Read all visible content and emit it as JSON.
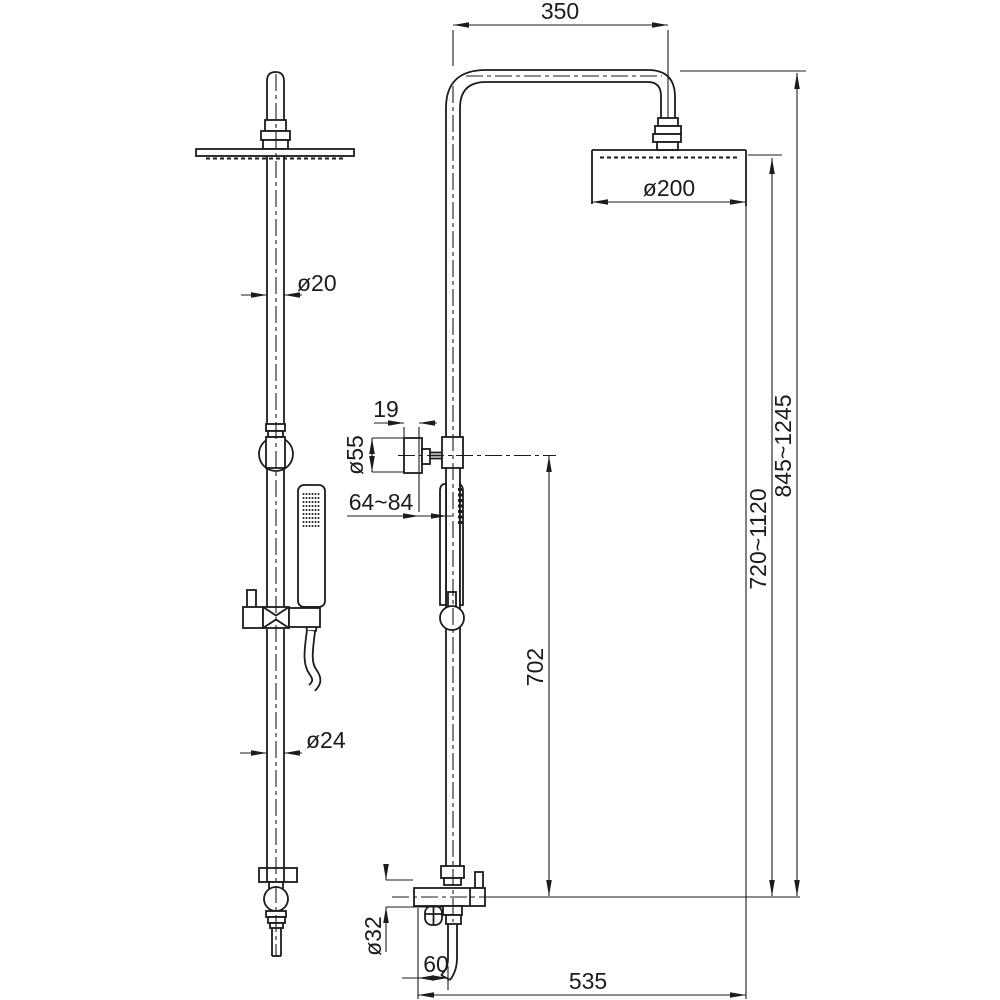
{
  "drawing": {
    "type": "technical-dimension-drawing",
    "subject": "shower column with rain head, hand shower and mixer valve (side view and front view)",
    "colors": {
      "line": "#1c1c1c",
      "background": "#ffffff"
    },
    "dimensions": {
      "arm_offset": "350",
      "head_diameter": "ø200",
      "upper_pipe_diameter": "ø20",
      "bracket_depth": "19",
      "bracket_face_diameter": "ø55",
      "wall_clearance": "64~84",
      "bracket_to_valve": "702",
      "head_to_valve": "720~1120",
      "overall_height": "845~1245",
      "lower_pipe_diameter": "ø24",
      "valve_diameter": "ø32",
      "outlet_offset": "60",
      "valve_to_head_edge": "535"
    }
  }
}
